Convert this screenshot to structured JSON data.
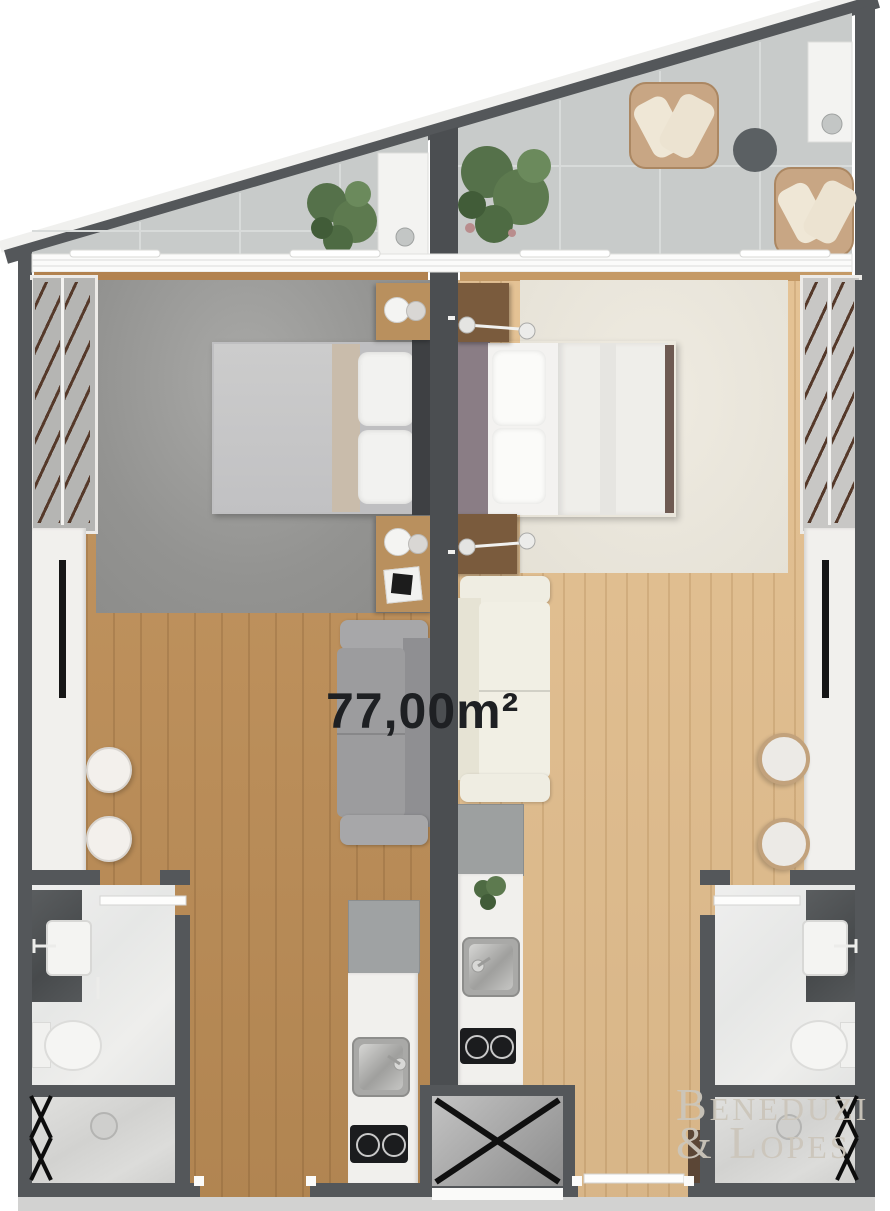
{
  "labels": {
    "area": "77,00m²",
    "brand_line1": "Beneduzi",
    "brand_line2": "& Lopes"
  },
  "palette": {
    "wall": "#54575a",
    "wall_center": "#4b4e51",
    "balcony_tile": "#c8cbca",
    "wood_left": "#c09058",
    "wood_right": "#e3bf8f",
    "rug_left": "#969694",
    "rug_right": "#eae6dc",
    "marble_light": "#e9e9e7",
    "vanity_stone": "#4f5254",
    "counter_white": "#f1f0ed",
    "sofa_left": "#9c9c9e",
    "sofa_right": "#f1efe4",
    "wicker": "#c8a684",
    "plant_green": "#5d7a4f",
    "area_text": "#1e2023",
    "brand_text": "#ccc6bb"
  },
  "units": {
    "left": {
      "rooms": [
        "balcony",
        "bedroom",
        "living-dining",
        "kitchen",
        "bathroom"
      ],
      "furniture": [
        "balcony-plant",
        "balcony-bar-sink",
        "double-bed",
        "nightstand",
        "wardrobe-hangers",
        "tv-counter",
        "tv",
        "bar-stools",
        "sofa",
        "side-desk",
        "fridge",
        "kitchen-sink",
        "cooktop",
        "vanity-sink",
        "toilet",
        "shower",
        "towel-rack"
      ]
    },
    "right": {
      "rooms": [
        "balcony",
        "bedroom",
        "living-dining",
        "kitchen",
        "bathroom"
      ],
      "furniture": [
        "balcony-plant",
        "wicker-armchairs",
        "side-table",
        "balcony-bar-sink",
        "double-bed",
        "nightstand",
        "reading-lamps",
        "wardrobe-hangers",
        "tv-counter",
        "tv",
        "bar-stools",
        "sofa",
        "fridge",
        "kitchen-sink",
        "cooktop",
        "vanity-sink",
        "toilet",
        "shower",
        "towel-rack"
      ]
    },
    "shared": [
      "elevator-shaft"
    ]
  }
}
